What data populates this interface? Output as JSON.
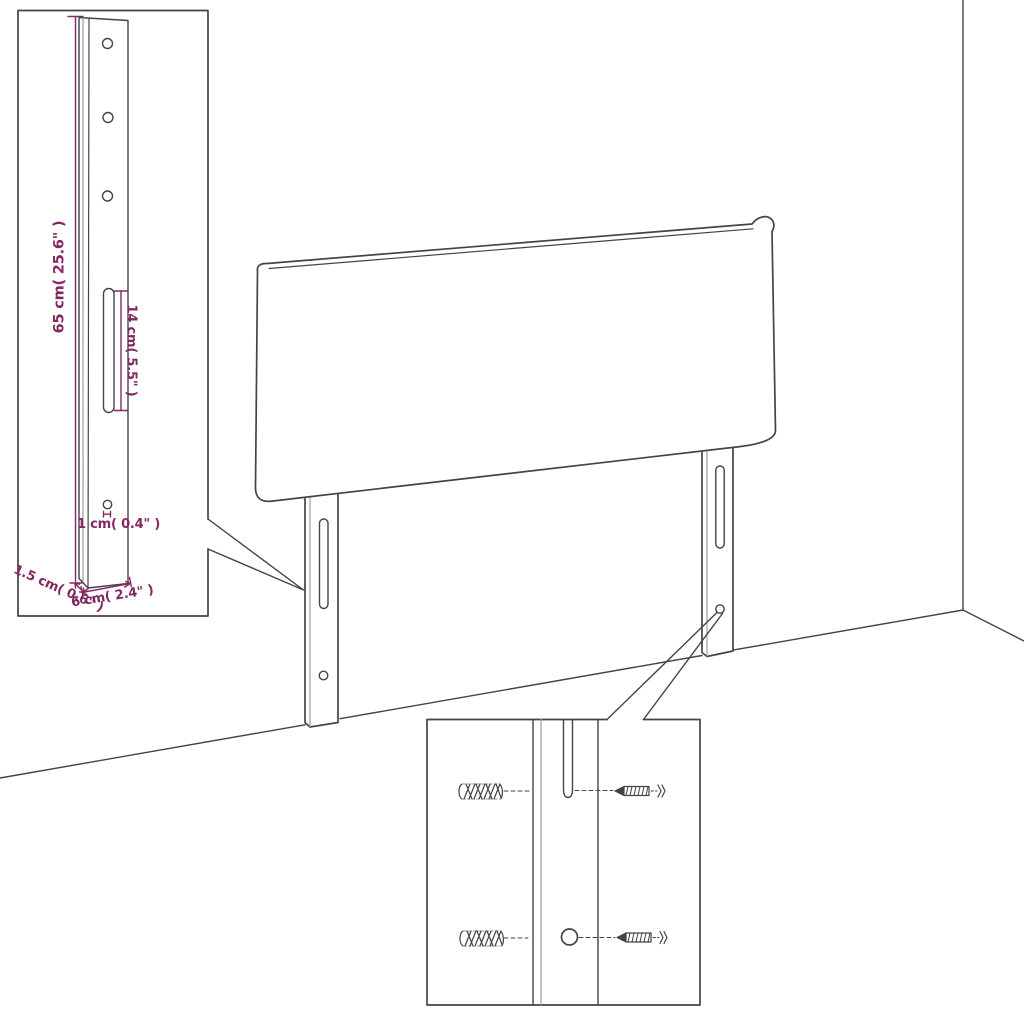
{
  "title": "Headboard with legs - assembly dimension diagram",
  "colors": {
    "background": "#ffffff",
    "line": "#444444",
    "line_light": "#9e9e9e",
    "dimension": "#822963"
  },
  "bracket_inset": {
    "dim_height": "65 cm( 25.6\" )",
    "dim_slot": "14 cm( 5.5\" )",
    "dim_hole": "1 cm( 0.4\"  )",
    "dim_thickness": "1.5 cm( 0.6\" )",
    "dim_width": "6 cm( 2.4\" )",
    "hole_count": 3
  },
  "mounting_inset": {
    "wall_plug_count": 2,
    "screw_count": 2
  }
}
